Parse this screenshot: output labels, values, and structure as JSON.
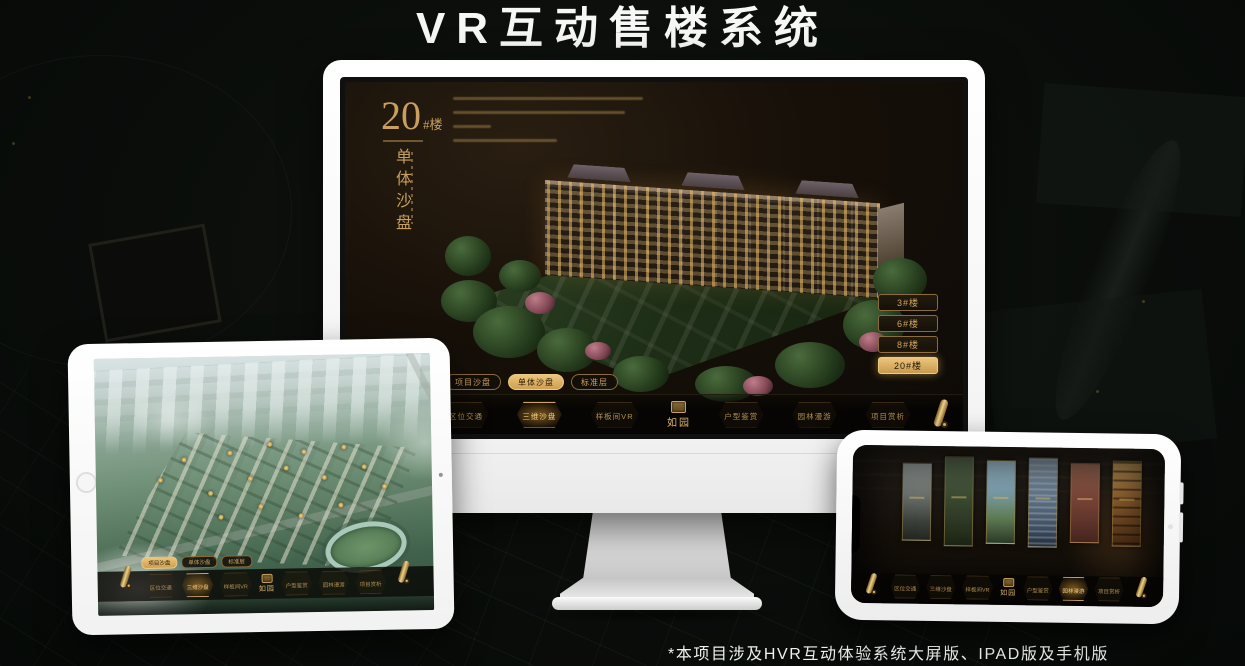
{
  "title": {
    "text": "VR互动售楼系统"
  },
  "footnote": {
    "text": "*本项目涉及HVR互动体验系统大屏版、IPAD版及手机版"
  },
  "colors": {
    "gold": "#c99f5d",
    "gold_bright": "#ecc57b",
    "gold_dark": "#8a6c38",
    "screen_brown": "#171009",
    "background": "#0a0d0a"
  },
  "logo": {
    "text": "如园"
  },
  "icons": {
    "scroll": "scroll-roll-icon",
    "seal": "logo-seal-icon",
    "home": "home-button",
    "camera": "camera-dot"
  },
  "monitor": {
    "device": "desktop-display",
    "heading": {
      "number": "20",
      "suffix": "#楼",
      "vertical_title": "单体沙盘"
    },
    "floor_buttons": [
      {
        "label": "3#楼",
        "active": false
      },
      {
        "label": "6#楼",
        "active": false
      },
      {
        "label": "8#楼",
        "active": false
      },
      {
        "label": "20#楼",
        "active": true
      }
    ],
    "mode_tabs": [
      {
        "label": "项目沙盘",
        "active": false
      },
      {
        "label": "单体沙盘",
        "active": true
      },
      {
        "label": "标准层",
        "active": false
      }
    ],
    "nav": {
      "items_left": [
        {
          "label": "区位交通",
          "active": false
        },
        {
          "label": "三维沙盘",
          "active": true
        },
        {
          "label": "样板间VR",
          "active": false
        }
      ],
      "items_right": [
        {
          "label": "户型鉴赏",
          "active": false
        },
        {
          "label": "园林漫游",
          "active": false
        },
        {
          "label": "项目赏析",
          "active": false
        }
      ]
    }
  },
  "tablet": {
    "device": "ipad",
    "mode_tabs": [
      {
        "label": "项目沙盘",
        "active": true
      },
      {
        "label": "单体沙盘",
        "active": false
      },
      {
        "label": "标准层",
        "active": false
      }
    ],
    "nav": {
      "items_left": [
        {
          "label": "区位交通",
          "active": false
        },
        {
          "label": "三维沙盘",
          "active": true
        },
        {
          "label": "样板间VR",
          "active": false
        }
      ],
      "items_right": [
        {
          "label": "户型鉴赏",
          "active": false
        },
        {
          "label": "园林漫游",
          "active": false
        },
        {
          "label": "项目赏析",
          "active": false
        }
      ]
    }
  },
  "phone": {
    "device": "mobile",
    "nav": {
      "items_left": [
        {
          "label": "区位交通",
          "active": false
        },
        {
          "label": "三维沙盘",
          "active": false
        },
        {
          "label": "样板间VR",
          "active": false
        }
      ],
      "items_right": [
        {
          "label": "户型鉴赏",
          "active": false
        },
        {
          "label": "园林漫游",
          "active": true
        },
        {
          "label": "项目赏析",
          "active": false
        }
      ]
    }
  }
}
